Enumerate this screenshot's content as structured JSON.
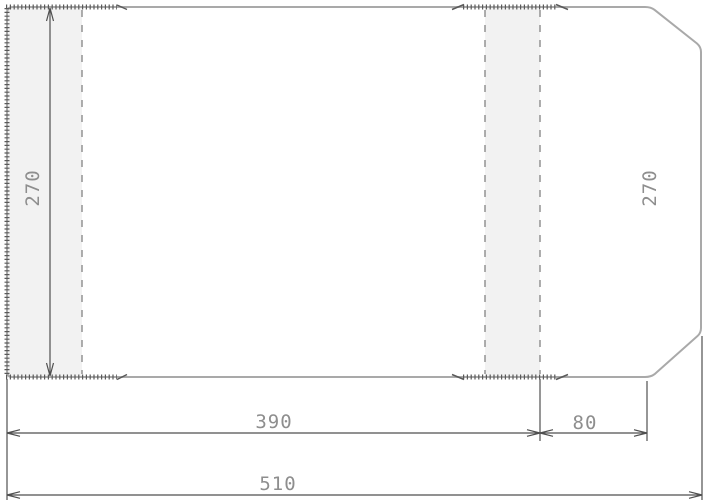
{
  "drawing": {
    "kind": "technical-dimension-drawing",
    "dimension_labels": {
      "height_left": "270",
      "height_right": "270",
      "width_main": "390",
      "width_flap": "80",
      "width_total": "510"
    },
    "colors": {
      "background": "#ffffff",
      "outline": "#a9a9a9",
      "panel_fill": "#f2f2f2",
      "fold_line": "#8c8c8c",
      "seam": "#5a5a5a",
      "dimension_line": "#4f4f4f",
      "dimension_text": "#8e8e8e"
    }
  }
}
